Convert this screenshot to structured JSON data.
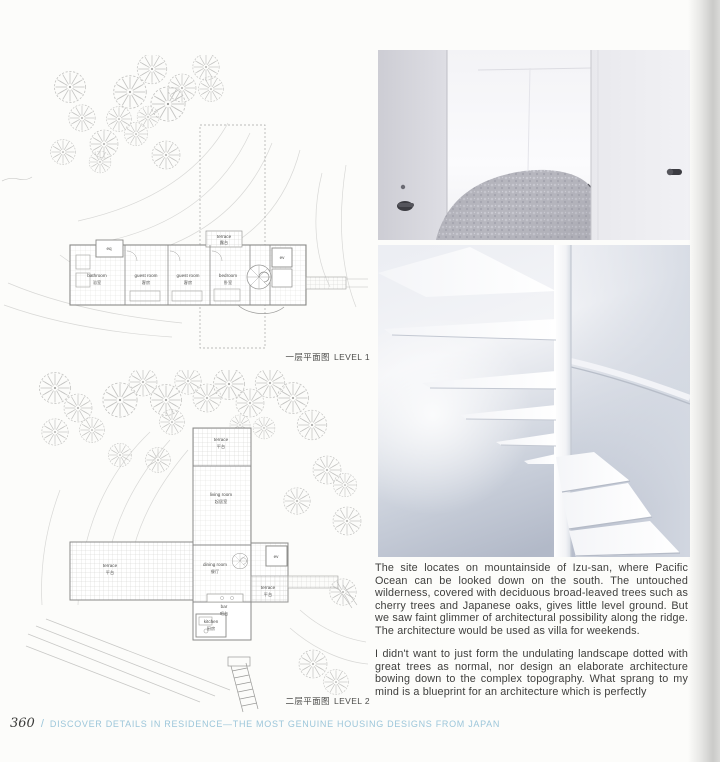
{
  "footer": {
    "page_number": "360",
    "separator": "/",
    "title": "DISCOVER DETAILS IN RESIDENCE—THE MOST GENUINE HOUSING DESIGNS FROM JAPAN"
  },
  "plans": {
    "level1": {
      "caption_zh": "一层平面图",
      "caption_en": "LEVEL 1",
      "rooms": {
        "bathroom": {
          "en": "bathroom",
          "zh": "浴室"
        },
        "eq": {
          "en": "eq"
        },
        "guest1": {
          "en": "guest room",
          "zh": "客房"
        },
        "guest2": {
          "en": "guest room",
          "zh": "客房"
        },
        "bedroom": {
          "en": "bedroom",
          "zh": "卧室"
        },
        "terrace": {
          "en": "terrace",
          "zh": "露台"
        },
        "ev": {
          "en": "ev"
        }
      }
    },
    "level2": {
      "caption_zh": "二层平面图",
      "caption_en": "LEVEL 2",
      "rooms": {
        "terrace_top": {
          "en": "terrace",
          "zh": "平台"
        },
        "living": {
          "en": "living room",
          "zh": "起居室"
        },
        "terrace_left": {
          "en": "terrace",
          "zh": "平台"
        },
        "dining": {
          "en": "dining room",
          "zh": "餐厅"
        },
        "terrace_right": {
          "en": "terrace",
          "zh": "平台"
        },
        "ev": {
          "en": "ev"
        },
        "bar": {
          "en": "bar",
          "zh": "吧台"
        },
        "kitchen": {
          "en": "kitchen",
          "zh": "厨房"
        }
      }
    }
  },
  "article": {
    "paragraph1": "The site locates on mountainside of Izu-san, where Pacific Ocean can be looked down on the south. The untouched wilderness, covered with deciduous broad-leaved trees such as cherry trees and Japanese oaks, gives little level ground. But we saw faint glimmer of architectural possibility along the ridge. The architecture would be used as villa for weekends.",
    "paragraph2": "I didn't want to just form the undulating landscape dotted with great trees as normal, nor design an elaborate architecture bowing down to the complex topography. What sprang to my mind is a blueprint for an architecture which is perfectly"
  },
  "photos": {
    "bedroom_alt": "white bedroom interior with curved wall and grey bed",
    "staircase_alt": "white spiral staircase with cantilevered treads"
  },
  "colors": {
    "footer_blue": "#9cc6da",
    "body_text": "#3e3e3c",
    "plan_line": "#9a9a98",
    "tree_line": "#c4c4c2",
    "page_edge": "#c9c9c7",
    "stair_shadow": "#c3c8d2",
    "bed_grey": "#b6b6be"
  }
}
